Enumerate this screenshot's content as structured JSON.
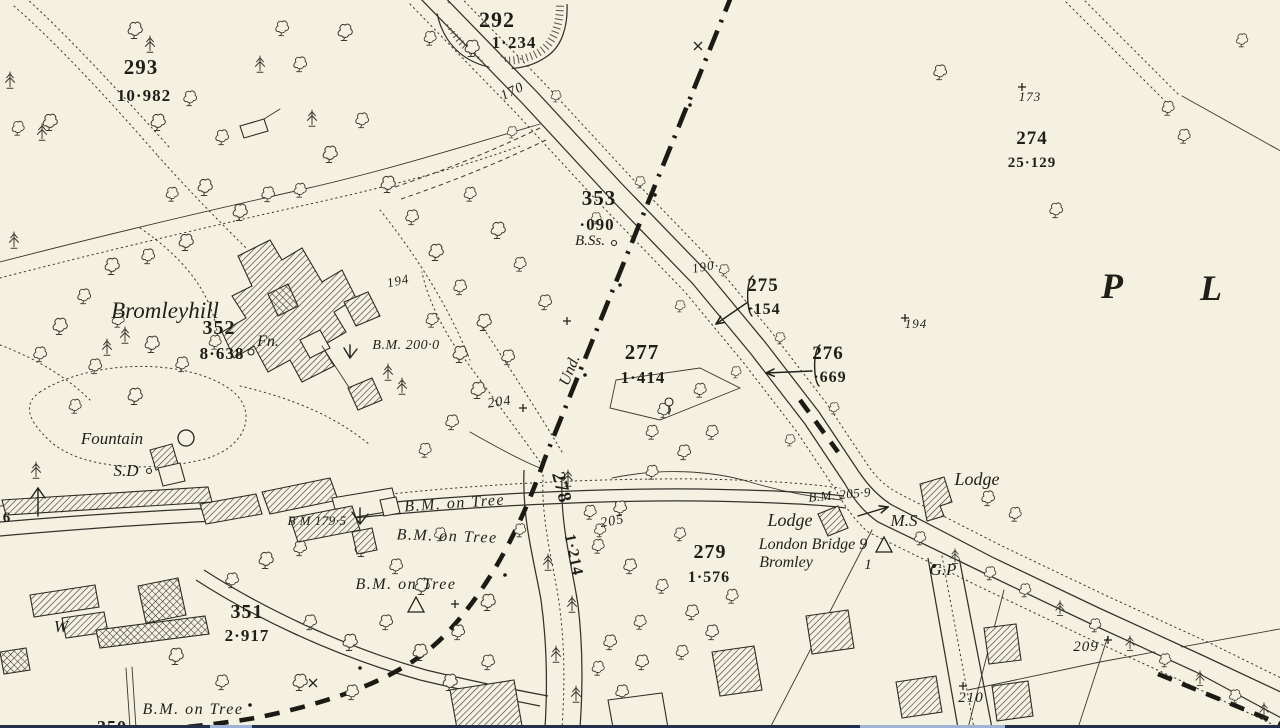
{
  "meta": {
    "kind": "historic-ordnance-survey-map-extract",
    "place_name": "Bromleyhill"
  },
  "colors": {
    "paper": "#f5f1e1",
    "ink": "#3a372e",
    "label_ink": "#201e18",
    "boundary_ink": "#1c1a15",
    "edge_strip_dark": "#242f4e",
    "edge_strip_light": "#9fb3d8"
  },
  "symbols": {
    "fountain": "circle",
    "milestone": "open-triangle",
    "boundary_mark": "plus-cross",
    "bench_mark": "broad-arrow",
    "deciduous_tree": "cloud-outline",
    "conifer_tree": "pine-glyph"
  },
  "milestone": {
    "destination": "London Bridge 9",
    "origin": "Bromley",
    "miles": "1"
  },
  "labels": [
    {
      "id": "parcel-292-number",
      "text": "292",
      "x": 497,
      "y": 27,
      "size": 22,
      "cls": "num"
    },
    {
      "id": "parcel-292-area",
      "text": "1·234",
      "x": 514,
      "y": 48,
      "size": 17,
      "cls": "num"
    },
    {
      "id": "parcel-293-number",
      "text": "293",
      "x": 141,
      "y": 74,
      "size": 21,
      "cls": "num"
    },
    {
      "id": "parcel-293-area",
      "text": "10·982",
      "x": 144,
      "y": 101,
      "size": 17,
      "cls": "num"
    },
    {
      "id": "road-number-170",
      "text": "170",
      "x": 514,
      "y": 95,
      "size": 14,
      "cls": "slope",
      "rot": -25
    },
    {
      "id": "parcel-353-number",
      "text": "353",
      "x": 599,
      "y": 205,
      "size": 21,
      "cls": "num"
    },
    {
      "id": "parcel-353-area",
      "text": "·090",
      "x": 597,
      "y": 230,
      "size": 17,
      "cls": "num"
    },
    {
      "id": "bench-boundary-stones",
      "text": "B.Ss.",
      "x": 590,
      "y": 245,
      "size": 15,
      "cls": "name"
    },
    {
      "id": "road-number-190",
      "text": "190",
      "x": 704,
      "y": 271,
      "size": 13,
      "cls": "slope",
      "rot": -10
    },
    {
      "id": "parcel-275-number",
      "text": "275",
      "x": 763,
      "y": 291,
      "size": 19,
      "cls": "num"
    },
    {
      "id": "parcel-275-area",
      "text": "·154",
      "x": 764,
      "y": 314,
      "size": 16,
      "cls": "num"
    },
    {
      "id": "parcel-276-number",
      "text": "276",
      "x": 828,
      "y": 359,
      "size": 19,
      "cls": "num"
    },
    {
      "id": "parcel-276-area",
      "text": "·669",
      "x": 830,
      "y": 382,
      "size": 16,
      "cls": "num"
    },
    {
      "id": "parcel-274-number",
      "text": "274",
      "x": 1032,
      "y": 144,
      "size": 19,
      "cls": "num"
    },
    {
      "id": "parcel-274-area",
      "text": "25·129",
      "x": 1032,
      "y": 167,
      "size": 15,
      "cls": "num"
    },
    {
      "id": "height-173",
      "text": "173",
      "x": 1030,
      "y": 101,
      "size": 13,
      "cls": "slope"
    },
    {
      "id": "height-194-east",
      "text": "194",
      "x": 916,
      "y": 328,
      "size": 13,
      "cls": "slope"
    },
    {
      "id": "height-194-west",
      "text": "194",
      "x": 399,
      "y": 285,
      "size": 13,
      "cls": "slope",
      "rot": -12
    },
    {
      "id": "placename-letter-p",
      "text": "P",
      "x": 1113,
      "y": 298,
      "size": 36,
      "cls": "big"
    },
    {
      "id": "placename-letter-l",
      "text": "L",
      "x": 1212,
      "y": 300,
      "size": 36,
      "cls": "big"
    },
    {
      "id": "house-name-bromleyhill",
      "text": "Bromleyhill",
      "x": 165,
      "y": 318,
      "size": 23,
      "cls": "name"
    },
    {
      "id": "parcel-352-number",
      "text": "352",
      "x": 219,
      "y": 334,
      "size": 20,
      "cls": "num"
    },
    {
      "id": "parcel-352-area",
      "text": "8·638",
      "x": 222,
      "y": 359,
      "size": 17,
      "cls": "num"
    },
    {
      "id": "feature-fn",
      "text": "Fn.",
      "x": 268,
      "y": 346,
      "size": 16,
      "cls": "name"
    },
    {
      "id": "bm-200-0",
      "text": "B.M. 200·0",
      "x": 406,
      "y": 349,
      "size": 14,
      "cls": "bmval"
    },
    {
      "id": "boundary-und",
      "text": "Und.",
      "x": 574,
      "y": 372,
      "size": 16,
      "cls": "name",
      "rot": -68
    },
    {
      "id": "parcel-277-number",
      "text": "277",
      "x": 642,
      "y": 359,
      "size": 21,
      "cls": "num"
    },
    {
      "id": "parcel-277-area",
      "text": "1·414",
      "x": 643,
      "y": 383,
      "size": 17,
      "cls": "num"
    },
    {
      "id": "height-204",
      "text": "204",
      "x": 500,
      "y": 406,
      "size": 14,
      "cls": "slope",
      "rot": -8
    },
    {
      "id": "feature-fountain",
      "text": "Fountain",
      "x": 112,
      "y": 444,
      "size": 17,
      "cls": "name"
    },
    {
      "id": "feature-sd",
      "text": "S.D",
      "x": 126,
      "y": 476,
      "size": 17,
      "cls": "name"
    },
    {
      "id": "bm-179-5",
      "text": "B M 179·5",
      "x": 317,
      "y": 525,
      "size": 13,
      "cls": "bmval"
    },
    {
      "id": "bench-tree-1",
      "text": "B.M. on Tree",
      "x": 455,
      "y": 508,
      "size": 16,
      "cls": "bench",
      "rot": -4
    },
    {
      "id": "bench-tree-2",
      "text": "B.M. on Tree",
      "x": 447,
      "y": 541,
      "size": 16,
      "cls": "bench",
      "rot": 2
    },
    {
      "id": "bench-tree-3",
      "text": "B.M. on Tree",
      "x": 406,
      "y": 589,
      "size": 16,
      "cls": "bench"
    },
    {
      "id": "parcel-351-number",
      "text": "351",
      "x": 247,
      "y": 618,
      "size": 20,
      "cls": "num"
    },
    {
      "id": "parcel-351-area",
      "text": "2·917",
      "x": 247,
      "y": 641,
      "size": 17,
      "cls": "num"
    },
    {
      "id": "feature-w",
      "text": "W",
      "x": 61,
      "y": 632,
      "size": 17,
      "cls": "name"
    },
    {
      "id": "bench-tree-4",
      "text": "B.M. on Tree",
      "x": 193,
      "y": 714,
      "size": 16,
      "cls": "bench"
    },
    {
      "id": "height-205",
      "text": "205",
      "x": 613,
      "y": 525,
      "size": 14,
      "cls": "slope",
      "rot": -10
    },
    {
      "id": "parcel-279-number",
      "text": "279",
      "x": 710,
      "y": 558,
      "size": 20,
      "cls": "num"
    },
    {
      "id": "parcel-279-area",
      "text": "1·576",
      "x": 709,
      "y": 582,
      "size": 16,
      "cls": "num"
    },
    {
      "id": "parcel-278-number",
      "text": "278",
      "x": 556,
      "y": 489,
      "size": 19,
      "cls": "num",
      "rot": 75
    },
    {
      "id": "parcel-278-area",
      "text": "1·214",
      "x": 569,
      "y": 556,
      "size": 16,
      "cls": "num",
      "rot": 78
    },
    {
      "id": "lodge-west",
      "text": "Lodge",
      "x": 790,
      "y": 526,
      "size": 18,
      "cls": "name"
    },
    {
      "id": "milestone-destination",
      "text": "London Bridge 9",
      "x": 813,
      "y": 549,
      "size": 16,
      "cls": "name"
    },
    {
      "id": "milestone-origin",
      "text": "Bromley",
      "x": 786,
      "y": 567,
      "size": 16,
      "cls": "name"
    },
    {
      "id": "milestone-miles",
      "text": "1",
      "x": 868,
      "y": 569,
      "size": 15,
      "cls": "name"
    },
    {
      "id": "bm-205-9",
      "text": "B.M. 205·9",
      "x": 840,
      "y": 499,
      "size": 13,
      "cls": "bmval",
      "rot": -5
    },
    {
      "id": "feature-ms",
      "text": "M.S",
      "x": 904,
      "y": 526,
      "size": 17,
      "cls": "name"
    },
    {
      "id": "lodge-east",
      "text": "Lodge",
      "x": 977,
      "y": 485,
      "size": 18,
      "cls": "name"
    },
    {
      "id": "feature-gp",
      "text": "G.P",
      "x": 943,
      "y": 575,
      "size": 17,
      "cls": "name"
    },
    {
      "id": "height-209",
      "text": "209",
      "x": 1086,
      "y": 651,
      "size": 15,
      "cls": "slope"
    },
    {
      "id": "height-210",
      "text": "210",
      "x": 971,
      "y": 702,
      "size": 15,
      "cls": "slope"
    },
    {
      "id": "edge-number-6",
      "text": "6",
      "x": 7,
      "y": 522,
      "size": 15,
      "cls": "num"
    },
    {
      "id": "parcel-350-partial",
      "text": "350",
      "x": 112,
      "y": 733,
      "size": 18,
      "cls": "num"
    }
  ]
}
